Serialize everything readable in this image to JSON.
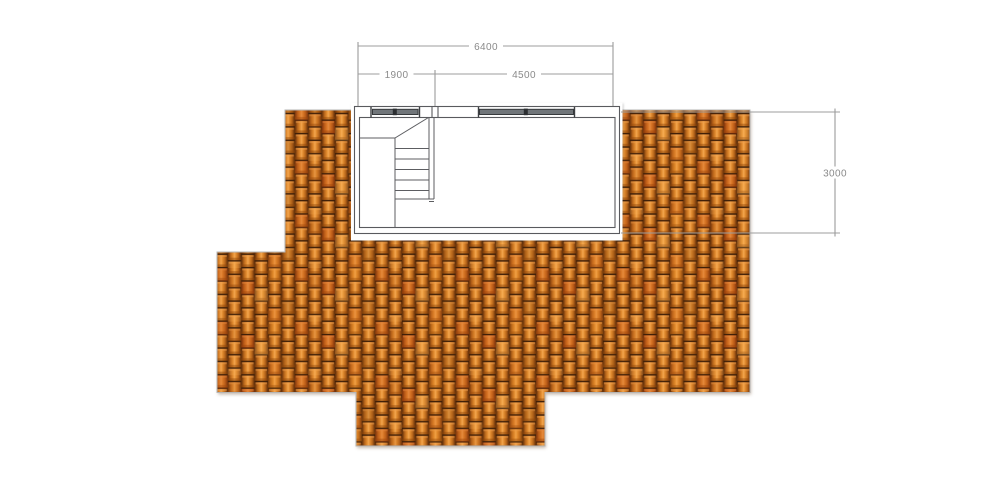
{
  "drawing": {
    "kind": "roof-plan-with-stair-room",
    "dimensions": {
      "total_width": "6400",
      "stair_bay_width": "1900",
      "room_bay_width": "4500",
      "room_depth": "3000"
    },
    "palette": {
      "tile_base": "#cf741c",
      "tile_highlight": "#f2a54e",
      "tile_edge": "#5e2f0a",
      "tile_cap_shadow": "#3f1f08",
      "roof_outline": "#b5b5b5",
      "floor_fill": "#d6dce2",
      "wall_line": "#595a5e",
      "window_glass": "#71767a",
      "window_mullion": "#2c2f32",
      "dimension_line": "#9c9c9c",
      "dimension_text": "#8a8a8a",
      "background": "#ffffff"
    }
  }
}
